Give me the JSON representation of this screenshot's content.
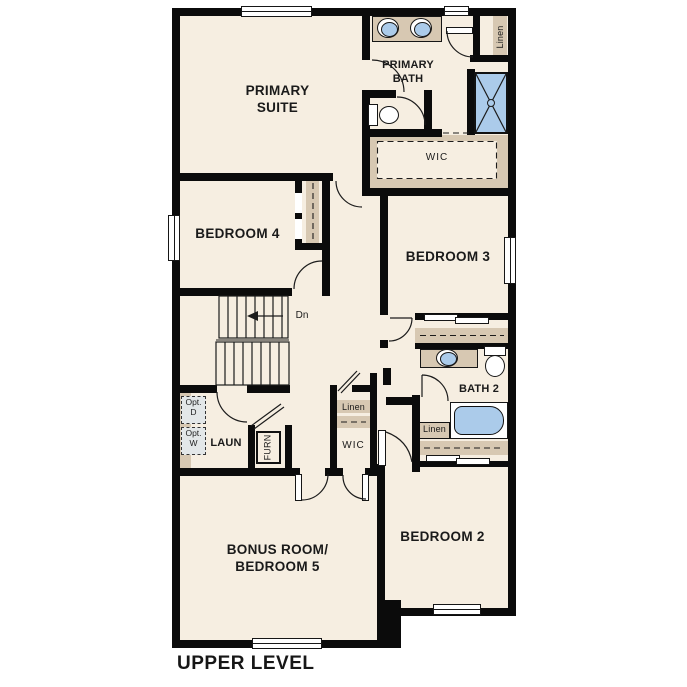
{
  "title": "UPPER LEVEL",
  "colors": {
    "wall": "#0b0b0b",
    "floor": "#f6eee1",
    "cabinetry_tan": "#d7c8b2",
    "fixture_blue": "#abcbea",
    "optional_fill": "#e3e7e8"
  },
  "labels": {
    "primary_suite_1": "PRIMARY",
    "primary_suite_2": "SUITE",
    "primary_bath_1": "PRIMARY",
    "primary_bath_2": "BATH",
    "wic_top": "WIC",
    "linen_top_right": "Linen",
    "bedroom4": "BEDROOM 4",
    "bedroom3": "BEDROOM 3",
    "stairs_dn": "Dn",
    "opt_d_1": "Opt.",
    "opt_d_2": "D",
    "opt_w_1": "Opt.",
    "opt_w_2": "W",
    "laundry": "LAUN",
    "furnace": "FURN",
    "linen_mid": "Linen",
    "wic_mid": "WIC",
    "linen_bath2": "Linen",
    "bath2": "BATH 2",
    "bedroom2": "BEDROOM 2",
    "bonus_1": "BONUS ROOM/",
    "bonus_2": "BEDROOM 5",
    "title": "UPPER LEVEL"
  }
}
